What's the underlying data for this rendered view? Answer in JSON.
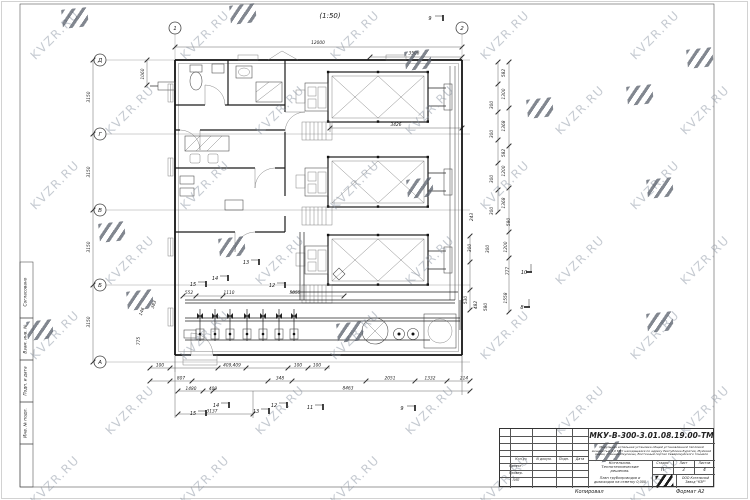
{
  "watermark": {
    "text": "KVZR.RU"
  },
  "title": {
    "scale_note": "(1:50)"
  },
  "grid": {
    "cols": [
      "1",
      "2"
    ],
    "rows": [
      "Д",
      "Г",
      "В",
      "Б",
      "А"
    ]
  },
  "dims": {
    "d12000": "12000",
    "d3506": "3506",
    "d3426": "3426",
    "d1060": "1060",
    "d3150": "3150",
    "d582": "582",
    "d1300": "1300",
    "d300": "300",
    "d1368": "1368",
    "d1200": "1200",
    "d243": "243",
    "d580": "580",
    "d777": "777",
    "d1558": "1558",
    "d530": "530",
    "d482": "482",
    "d100": "100",
    "d409409": "409,409",
    "d807": "807",
    "d348": "348",
    "d2051": "2051",
    "d1332": "1332",
    "d214": "214",
    "d1480": "1480",
    "d409": "409",
    "d8463": "8463",
    "d3137": "3137",
    "d552": "552",
    "d1110": "1110",
    "d5055": "5055",
    "d146": "146",
    "d383": "383",
    "d775": "775"
  },
  "marks": {
    "m8": "8",
    "m9": "9",
    "m10": "10",
    "m11": "11",
    "m12": "12",
    "m13": "13",
    "m14": "14",
    "m15": "15"
  },
  "frame": {
    "left_labels": [
      "Согласовано",
      "Взам. инв. №",
      "Подп. и дата",
      "Инв. № подл."
    ],
    "copy_label": "Копировал",
    "format_label": "Формат А2"
  },
  "title_block": {
    "doc_number": "МКУ-В-300-3.01.08.19.00-ТМ",
    "description": "Модульная котельная установка общей установленной тепловой мощностью 3,0 МВт находящаяся по адресу Республика Бурятия, Муйский район, станция Окусикан, Восточный портал Северомуйского тоннеля",
    "object_name": "Котельная. Теплотехнические решения.",
    "sheet_name": "План трубопроводов и дымоходов на отметку 0,000",
    "stage_label": "Стадия",
    "sheet_label": "Лист",
    "sheets_label": "Листов",
    "stage": "П",
    "sheet": "3",
    "sheets": "4",
    "company": "ООО Котельный Завод \"КЗР\"",
    "cols": [
      "Кол.уч",
      "N докум.",
      "Подп.",
      "Дата"
    ],
    "rows": [
      "Проект.",
      "Провер.",
      "ГИП"
    ]
  }
}
